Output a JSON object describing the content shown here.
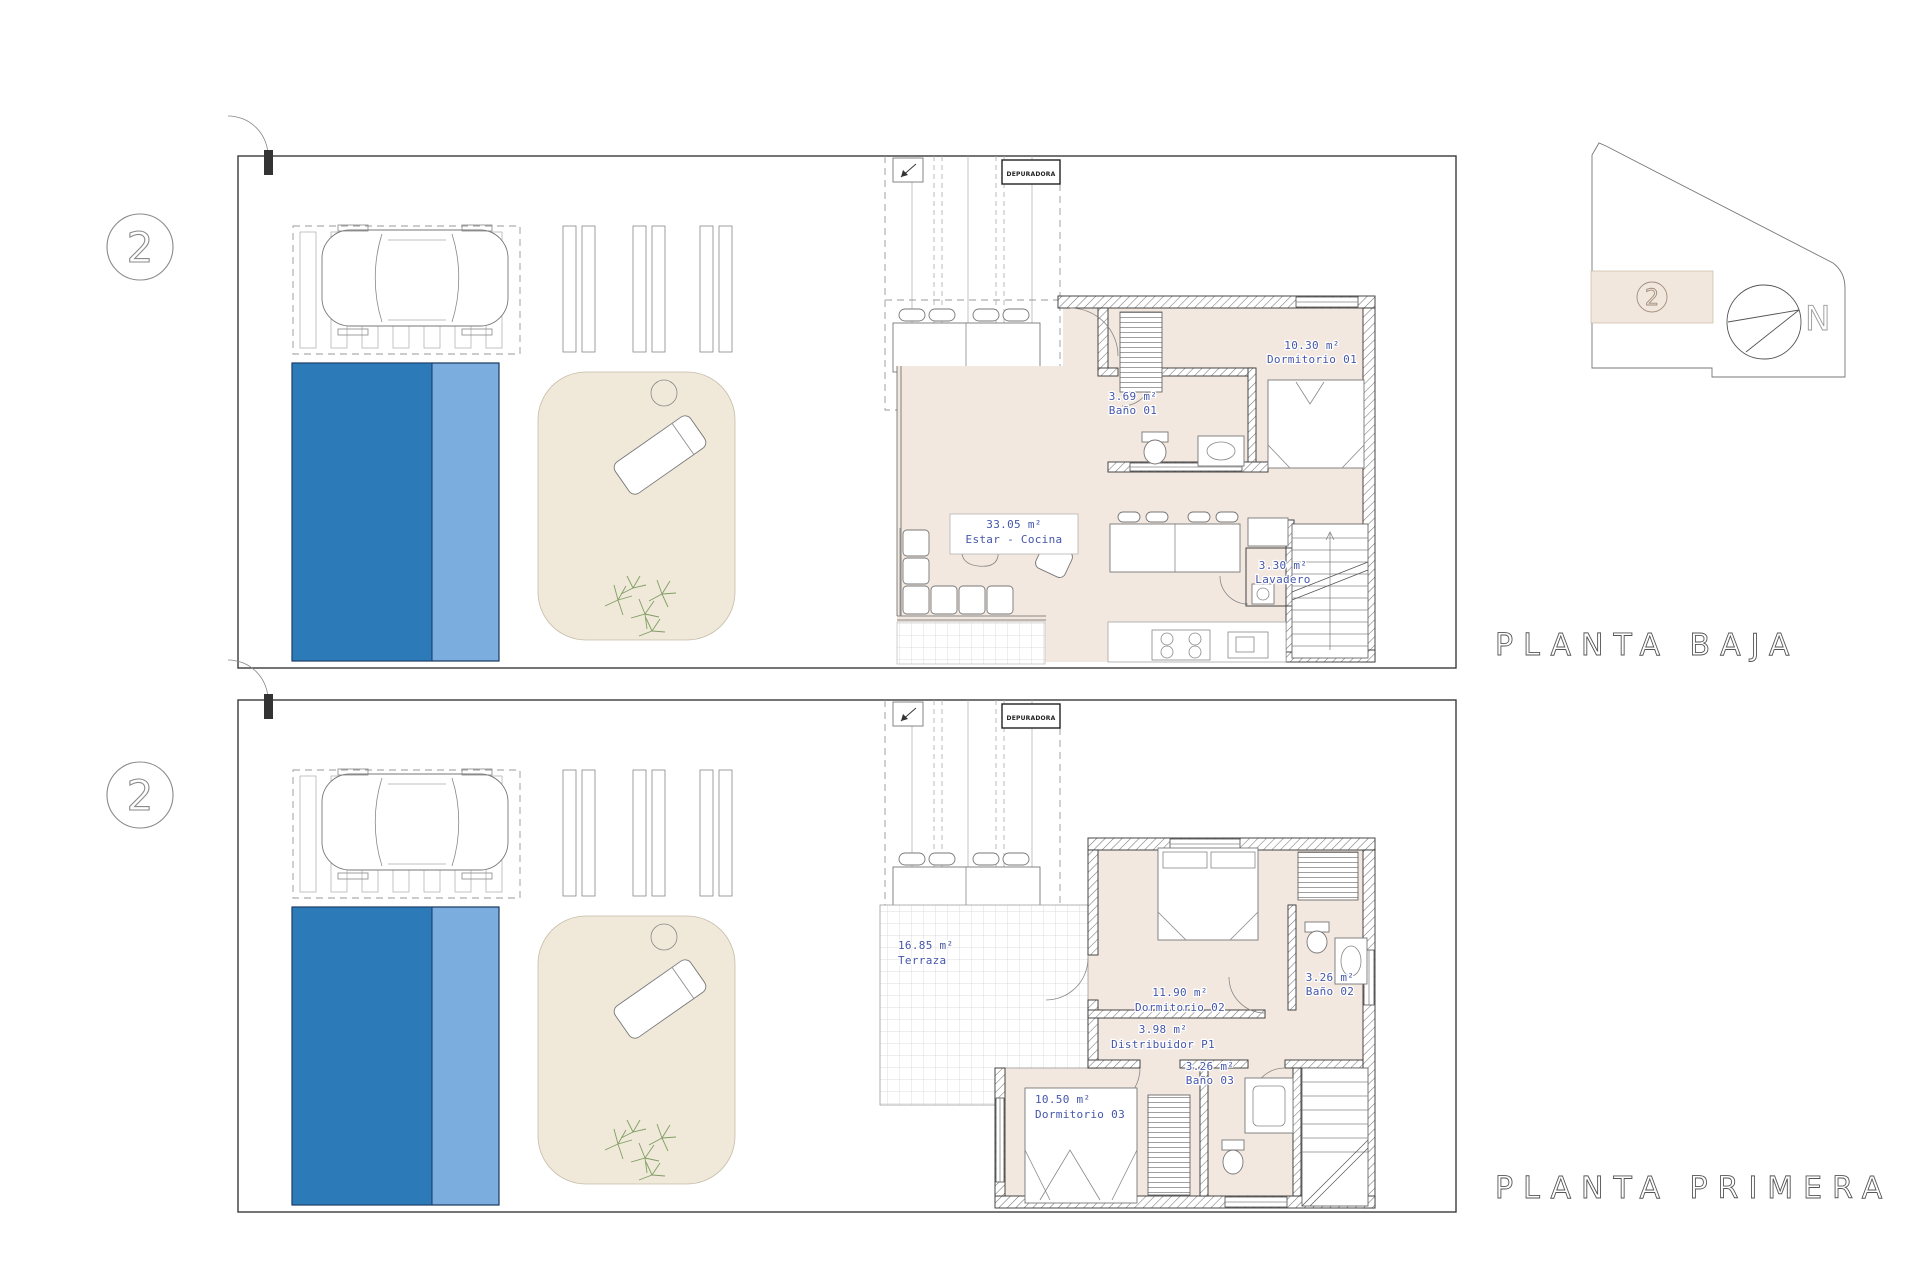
{
  "colors": {
    "pool_deep": "#2d7ab8",
    "pool_shallow": "#7badde",
    "interior_floor": "#f3e8e0",
    "garden_fill": "#f0e9da",
    "key_plan_highlight": "#f2e7dc",
    "room_label_text": "#4456aa",
    "linework": "#555555"
  },
  "plans": [
    {
      "title": "PLANTA BAJA",
      "badge": "2",
      "equipment_label": "DEPURADORA",
      "rooms": [
        {
          "area": "10.30 m²",
          "name": "Dormitorio 01"
        },
        {
          "area": "3.69 m²",
          "name": "Baño 01"
        },
        {
          "area": "33.05 m²",
          "name": "Estar - Cocina"
        },
        {
          "area": "3.30 m²",
          "name": "Lavadero"
        }
      ]
    },
    {
      "title": "PLANTA PRIMERA",
      "badge": "2",
      "equipment_label": "DEPURADORA",
      "rooms": [
        {
          "area": "16.85 m²",
          "name": "Terraza"
        },
        {
          "area": "11.90 m²",
          "name": "Dormitorio 02"
        },
        {
          "area": "3.26 m²",
          "name": "Baño 02"
        },
        {
          "area": "3.98 m²",
          "name": "Distribuidor P1"
        },
        {
          "area": "3.26 m²",
          "name": "Baño 03"
        },
        {
          "area": "10.50 m²",
          "name": "Dormitorio 03"
        }
      ]
    }
  ],
  "key_plan": {
    "unit_badge": "2",
    "north_label": "N"
  }
}
